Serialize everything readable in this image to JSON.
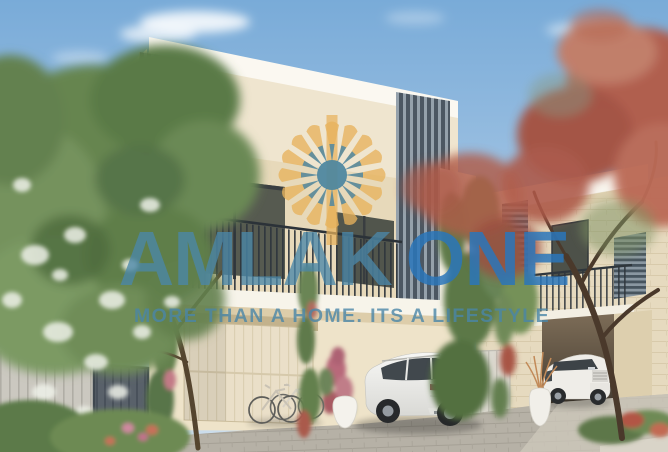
{
  "watermark": {
    "brand_first": "AMLAK",
    "brand_second": "ONE",
    "tagline": "MORE THAN A HOME. ITS A LIFESTYLE",
    "brand_first_color": "rgba(74,134,168,0.78)",
    "brand_second_color": "rgba(42,118,186,0.85)",
    "tagline_color": "rgba(74,134,168,0.8)",
    "logo": {
      "name": "amlak-sun-logo",
      "ray_color": "#e7b25c",
      "ring_color": "#4d87a2",
      "center_color": "#4b85a0"
    }
  },
  "scene": {
    "description": "Architectural render of modern two-storey townhouses with balconies, dark louver screens, garage, two white SUVs, bicycles, flowering trees and a paved driveway under a blue sky",
    "palette": {
      "sky_top": "#79abd8",
      "sky_bottom": "#cfdfec",
      "wall_cream": "#efe5cf",
      "fascia_white": "#f8f5ee",
      "louver_gray": "#4c5762",
      "stone_beige": "#e6dabf",
      "driveway_gray": "#b6b1a6",
      "tree_green": "#66854f",
      "tree_red": "#b25c4a",
      "railing_dark": "#2e353c"
    },
    "objects": [
      "main-townhouse",
      "second-townhouse",
      "white-suv-rear",
      "white-suv-front",
      "green-flowering-tree",
      "red-flowering-tree",
      "bicycles",
      "garage-door",
      "balcony-railings",
      "fence-and-gate",
      "planter-vases",
      "driveway"
    ]
  }
}
